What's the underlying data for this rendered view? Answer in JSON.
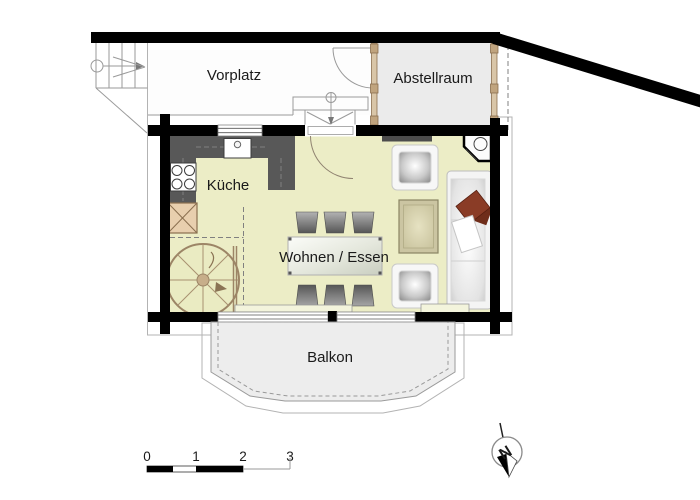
{
  "plan": {
    "rooms": {
      "vorplatz": "Vorplatz",
      "abstellraum": "Abstellraum",
      "kueche": "Küche",
      "wohnen_essen": "Wohnen / Essen",
      "balkon": "Balkon"
    },
    "compass": {
      "north": "N"
    },
    "scale": {
      "ticks": [
        "0",
        "1",
        "2",
        "3"
      ]
    },
    "colors": {
      "wall": "#000000",
      "floor": "#ecedc6",
      "counter": "#585858",
      "wood": "#c9b18f",
      "outdoor_area": "#ededed",
      "pillow": "#8a3c26"
    }
  }
}
